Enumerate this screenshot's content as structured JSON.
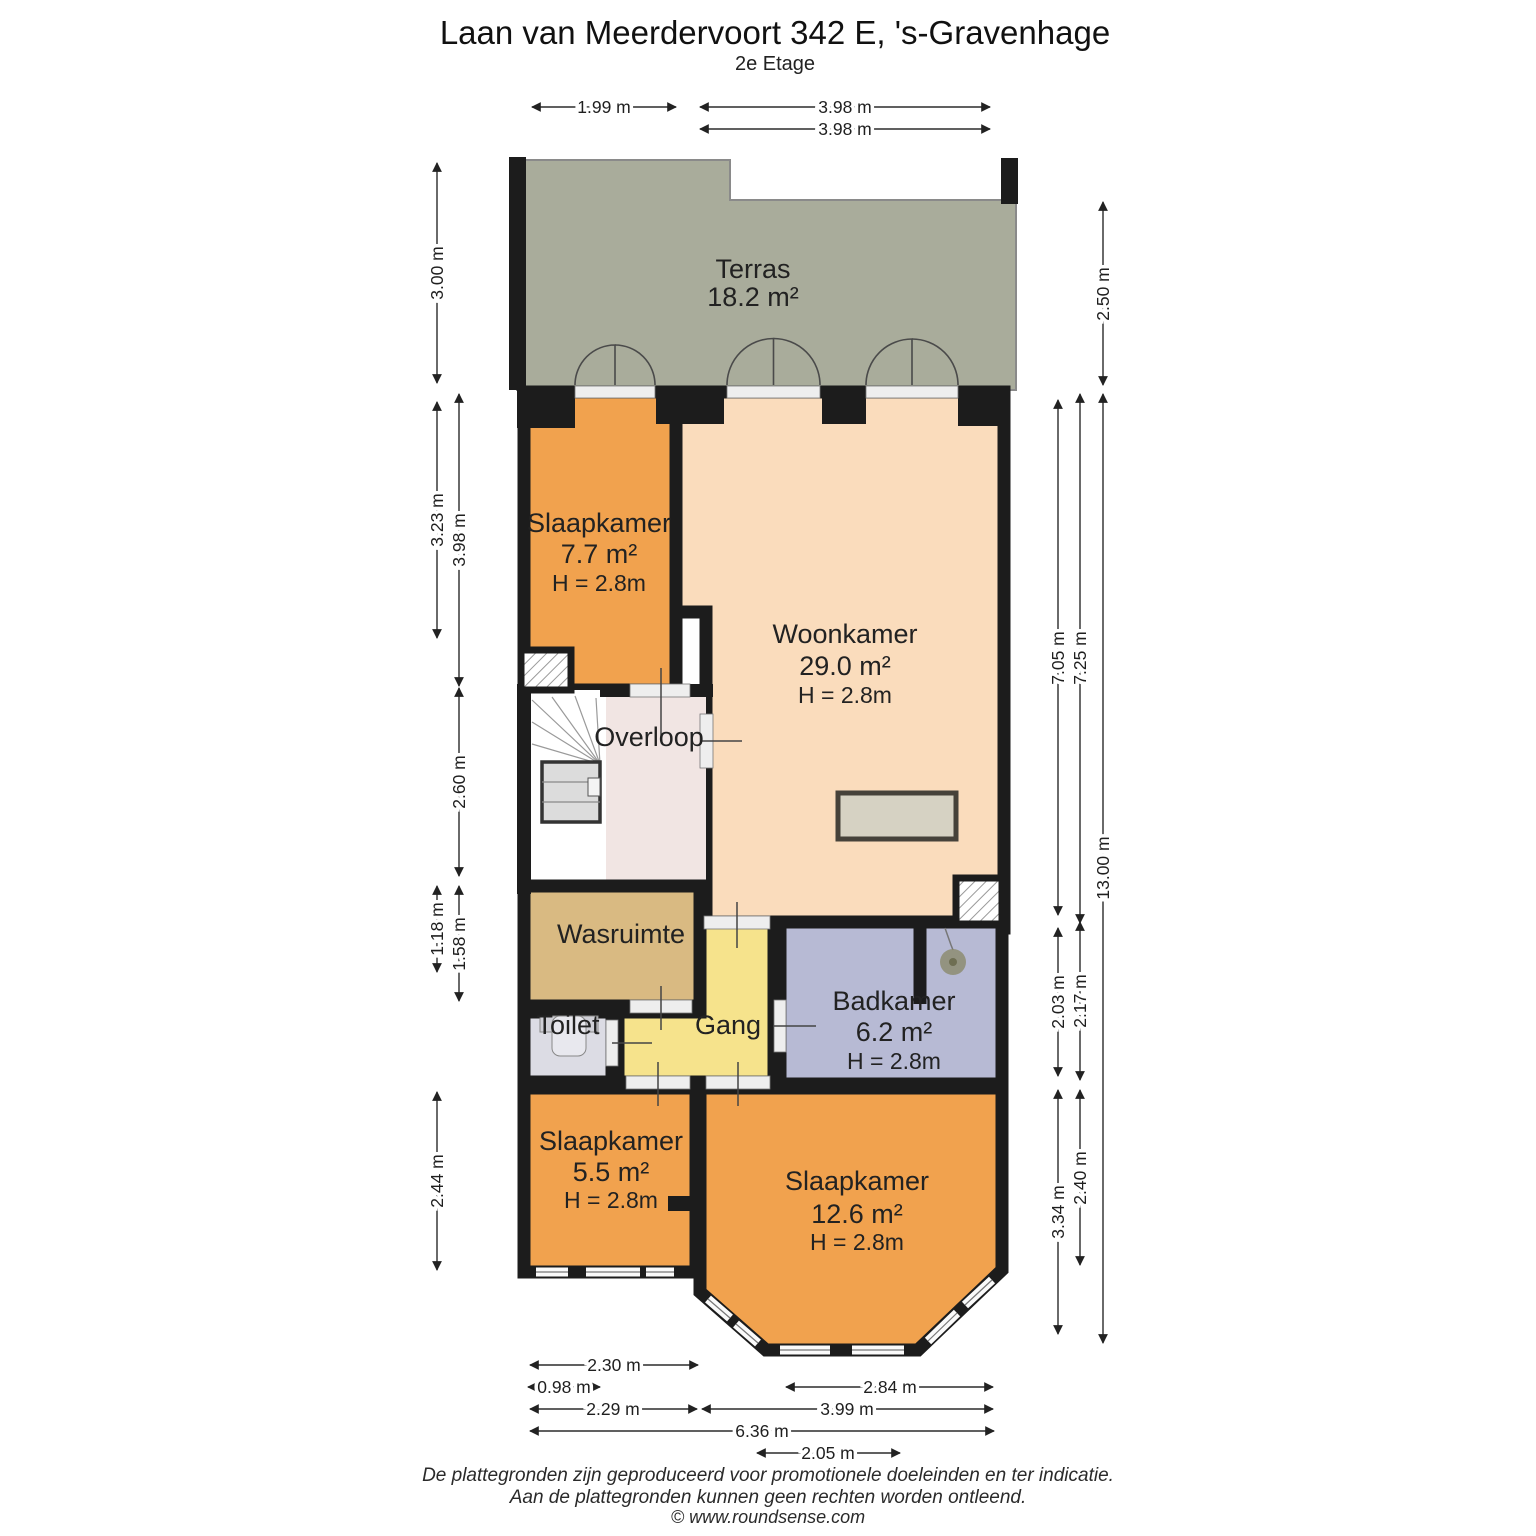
{
  "title": "Laan van Meerdervoort 342 E, 's-Gravenhage",
  "subtitle": "2e Etage",
  "rooms": {
    "terras": {
      "name": "Terras",
      "area": "18.2 m²"
    },
    "slaapkamer_7_7": {
      "name": "Slaapkamer",
      "area": "7.7 m²",
      "height": "H = 2.8m"
    },
    "woonkamer": {
      "name": "Woonkamer",
      "area": "29.0 m²",
      "height": "H = 2.8m"
    },
    "overloop": {
      "name": "Overloop"
    },
    "wasruimte": {
      "name": "Wasruimte"
    },
    "toilet": {
      "name": "Toilet"
    },
    "gang": {
      "name": "Gang"
    },
    "badkamer": {
      "name": "Badkamer",
      "area": "6.2 m²",
      "height": "H = 2.8m"
    },
    "slaapkamer_5_5": {
      "name": "Slaapkamer",
      "area": "5.5 m²",
      "height": "H = 2.8m"
    },
    "slaapkamer_12_6": {
      "name": "Slaapkamer",
      "area": "12.6 m²",
      "height": "H = 2.8m"
    }
  },
  "dimensions": {
    "top": [
      "1.99 m",
      "3.98 m",
      "3.98 m"
    ],
    "left": [
      "3.00 m",
      "3.23 m",
      "3.98 m",
      "2.60 m",
      "1.18 m",
      "1.58 m",
      "2.44 m"
    ],
    "right": [
      "2.50 m",
      "7.05 m",
      "7.25 m",
      "13.00 m",
      "2.03 m",
      "2.17 m",
      "3.34 m",
      "2.40 m"
    ],
    "bottom": [
      "2.30 m",
      "0.98 m",
      "2.84 m",
      "2.29 m",
      "3.99 m",
      "6.36 m",
      "2.05 m"
    ]
  },
  "footer": {
    "disclaimer_1": "De plattegronden zijn geproduceerd voor promotionele doeleinden en ter indicatie.",
    "disclaimer_2": "Aan de plattegronden kunnen geen rechten worden ontleend.",
    "copyright": "© www.roundsense.com"
  },
  "colors": {
    "wall": "#1c1c1c",
    "terras": "#a9ac9b",
    "bedroom_orange": "#f1a24e",
    "livingroom_peach": "#fadcbc",
    "overloop_pink": "#f1e5e3",
    "wasruimte_tan": "#d9ba82",
    "toilet_gray": "#dcdce4",
    "gang_yellow": "#f6e38c",
    "badkamer_blue": "#b7bad4"
  }
}
